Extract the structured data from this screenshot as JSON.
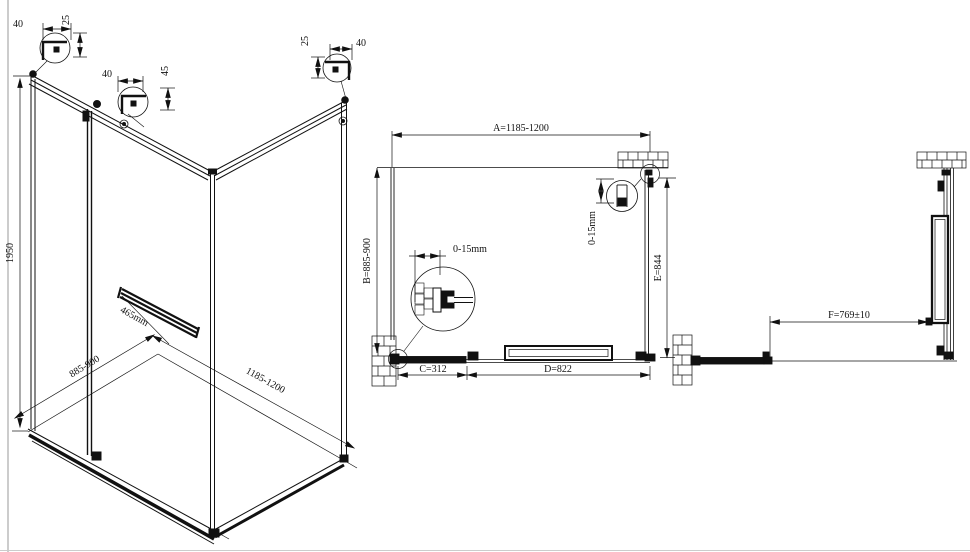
{
  "drawing": {
    "iso": {
      "height": "1950",
      "depth": "885-900",
      "width": "1185-1200",
      "towel_bar_length": "465mm",
      "detail_top_left": {
        "width": "40",
        "height": "25"
      },
      "detail_mid": {
        "width": "40",
        "height": "45"
      },
      "detail_top_right": {
        "width": "40",
        "height": "25"
      }
    },
    "plan": {
      "dim_a": "A=1185-1200",
      "dim_b": "B=885-900",
      "dim_c": "C=312",
      "dim_d": "D=822",
      "dim_e": "E=844",
      "wall_adjust_left": "0-15mm",
      "wall_adjust_right": "0-15mm"
    },
    "side": {
      "dim_f": "F=769±10"
    }
  }
}
